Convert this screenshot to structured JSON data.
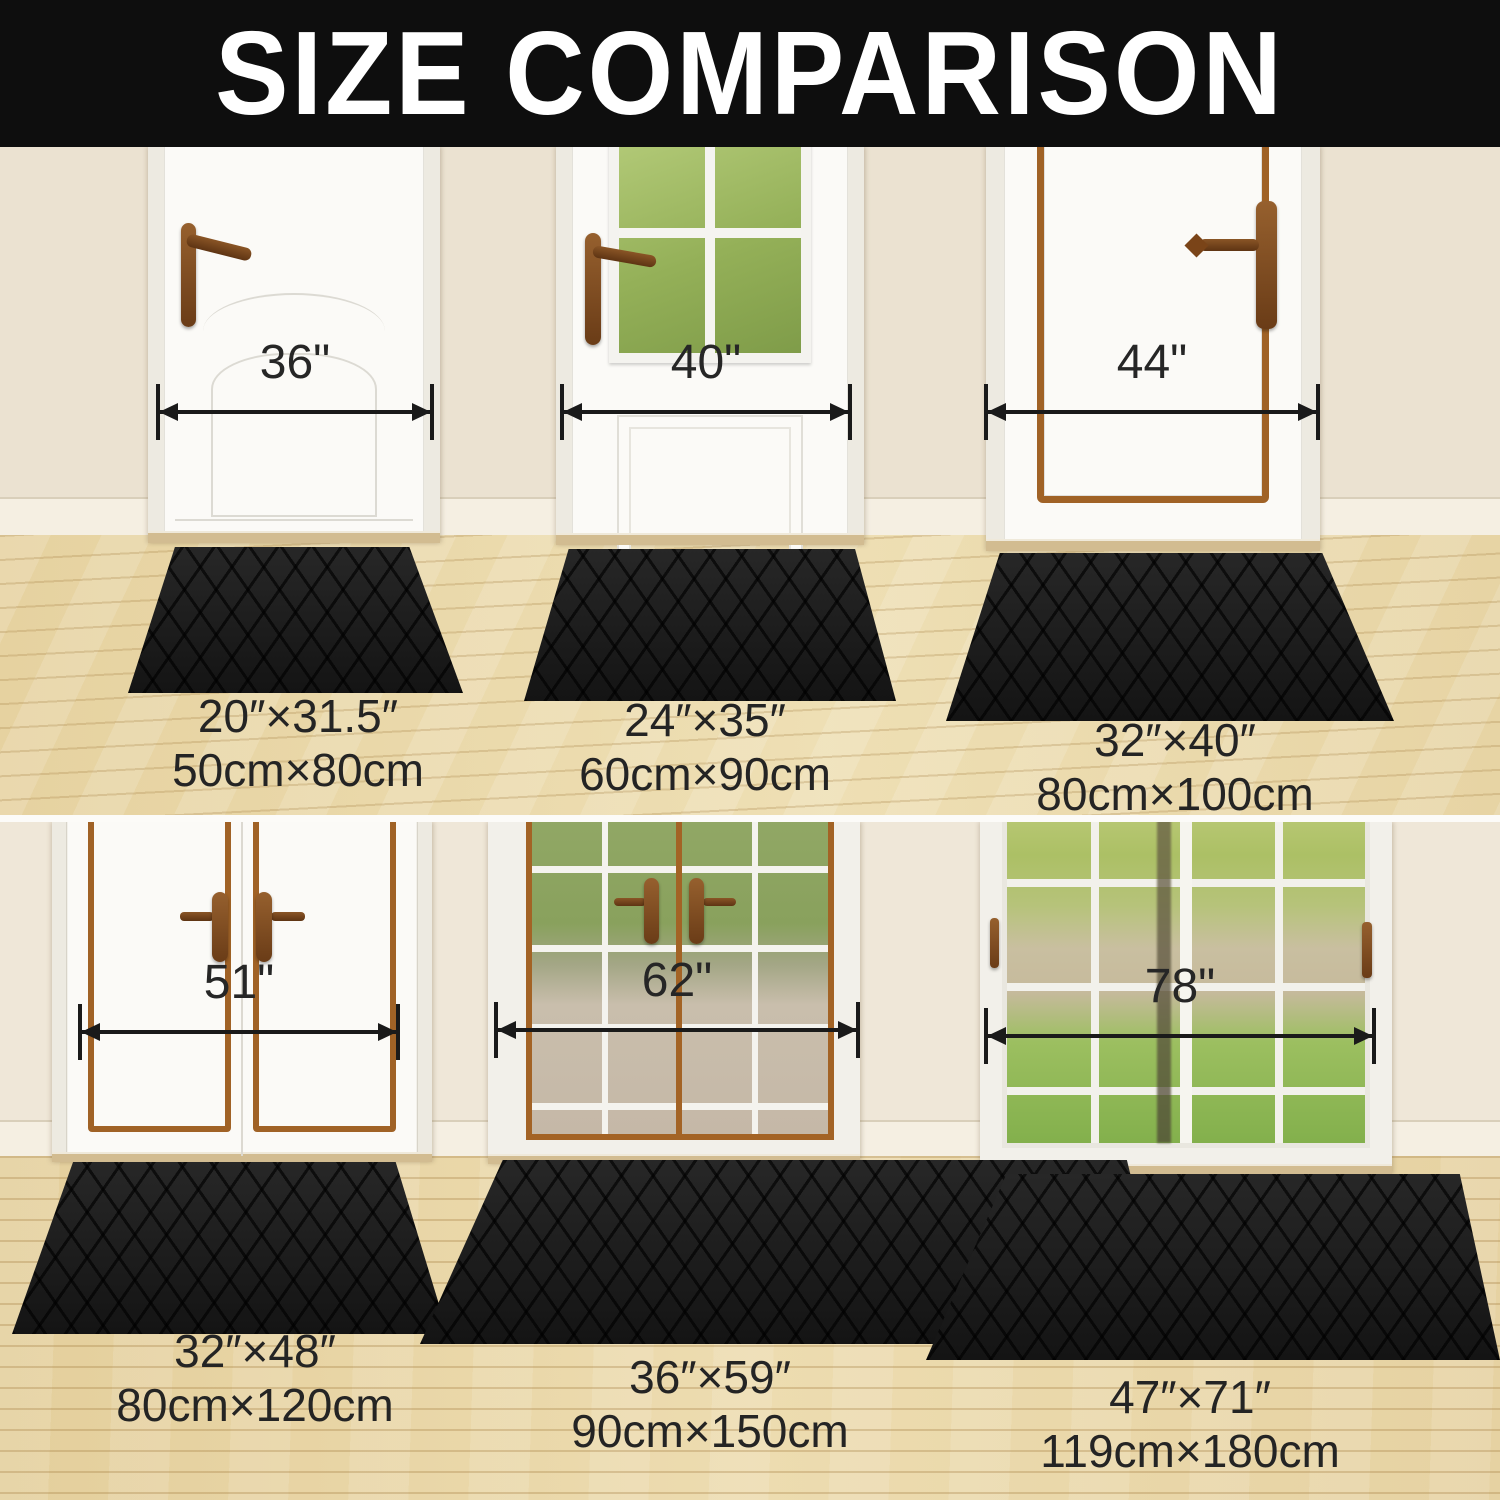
{
  "header": {
    "title": "SIZE COMPARISON"
  },
  "top_row": {
    "panels": [
      {
        "door_width": "36\"",
        "mat_size_in": "20″×31.5″",
        "mat_size_cm": "50cm×80cm"
      },
      {
        "door_width": "40\"",
        "mat_size_in": "24″×35″",
        "mat_size_cm": "60cm×90cm"
      },
      {
        "door_width": "44\"",
        "mat_size_in": "32″×40″",
        "mat_size_cm": "80cm×100cm"
      }
    ]
  },
  "bottom_row": {
    "panels": [
      {
        "door_width": "51\"",
        "mat_size_in": "32″×48″",
        "mat_size_cm": "80cm×120cm"
      },
      {
        "door_width": "62\"",
        "mat_size_in": "36″×59″",
        "mat_size_cm": "90cm×150cm"
      },
      {
        "door_width": "78\"",
        "mat_size_in": "47″×71″",
        "mat_size_cm": "119cm×180cm"
      }
    ]
  },
  "colors": {
    "banner": "#0e0e0e",
    "title_text": "#ffffff",
    "wall": "#ebe2d1",
    "baseboard": "#f5efe2",
    "floor_wood": "#e9d6a6",
    "mat_black": "#1b1b1b",
    "door_trim_brown": "#a06226",
    "handle_brown": "#7a4a21",
    "window_green": "#94ad58",
    "label_text": "#242424",
    "arrow": "#1a1a1a"
  }
}
